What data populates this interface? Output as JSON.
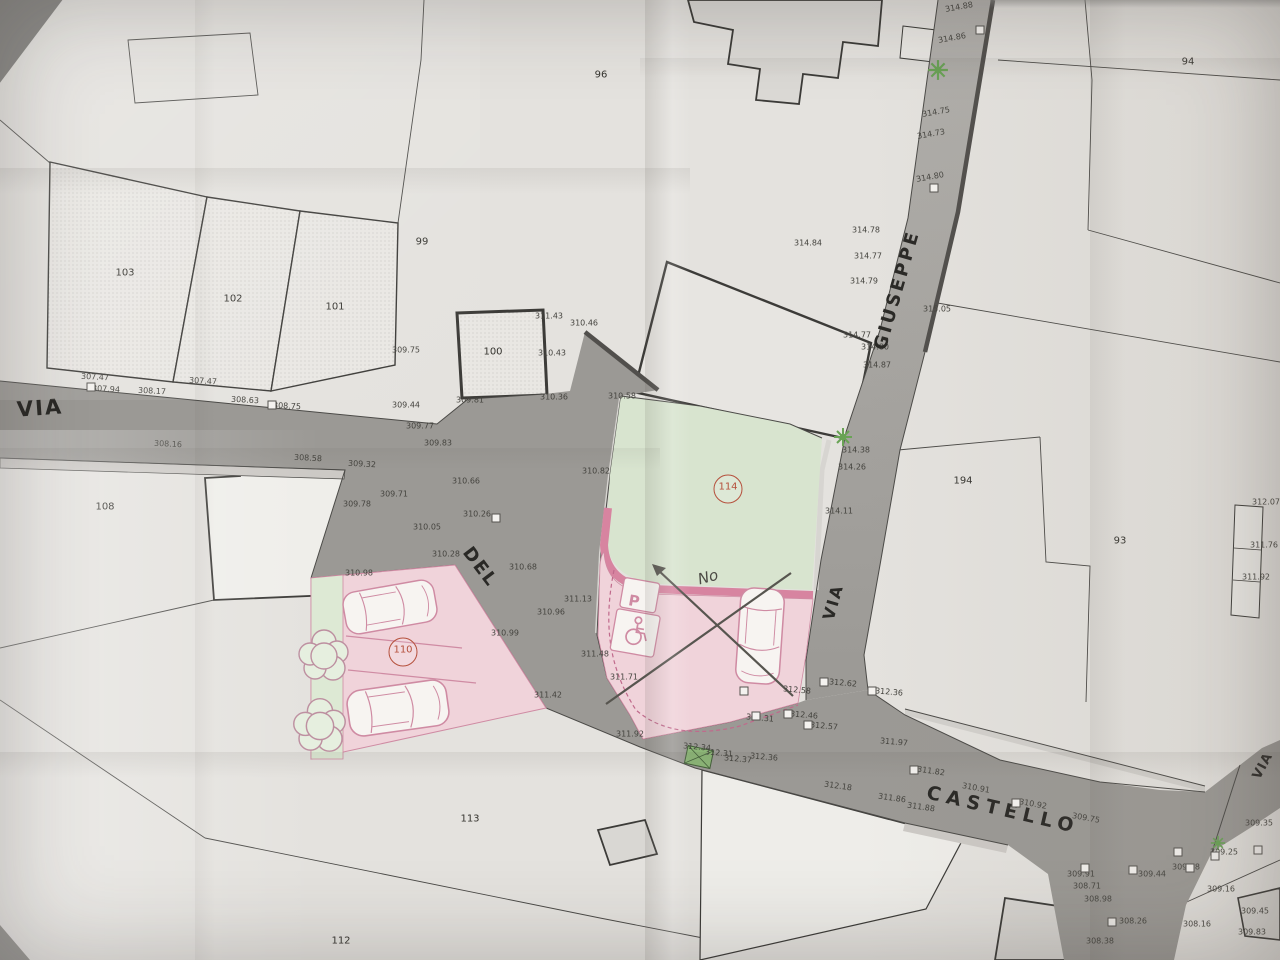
{
  "map": {
    "road_labels": [
      {
        "text": "VIA",
        "x": 40,
        "y": 408,
        "rot": -4,
        "size": 21,
        "ls": 2
      },
      {
        "text": "DEL",
        "x": 480,
        "y": 567,
        "rot": 53,
        "size": 18,
        "ls": 2
      },
      {
        "text": "CASTELLO",
        "x": 1003,
        "y": 810,
        "rot": 13,
        "size": 19,
        "ls": 6
      },
      {
        "text": "GIUSEPPE",
        "x": 897,
        "y": 290,
        "rot": -74,
        "size": 18,
        "ls": 3
      },
      {
        "text": "VIA",
        "x": 833,
        "y": 602,
        "rot": -74,
        "size": 16,
        "ls": 2
      },
      {
        "text": "VIA",
        "x": 1263,
        "y": 766,
        "rot": -62,
        "size": 13,
        "ls": 1
      }
    ],
    "parcel_labels": [
      {
        "text": "103",
        "x": 125,
        "y": 273
      },
      {
        "text": "102",
        "x": 233,
        "y": 299
      },
      {
        "text": "101",
        "x": 335,
        "y": 307
      },
      {
        "text": "99",
        "x": 422,
        "y": 242
      },
      {
        "text": "96",
        "x": 601,
        "y": 75
      },
      {
        "text": "100",
        "x": 493,
        "y": 352
      },
      {
        "text": "108",
        "x": 105,
        "y": 507
      },
      {
        "text": "113",
        "x": 470,
        "y": 819
      },
      {
        "text": "112",
        "x": 341,
        "y": 941
      },
      {
        "text": "194",
        "x": 963,
        "y": 481
      },
      {
        "text": "93",
        "x": 1120,
        "y": 541
      },
      {
        "text": "94",
        "x": 1188,
        "y": 62
      }
    ],
    "zone_badges": [
      {
        "text": "110",
        "x": 403,
        "y": 652
      },
      {
        "text": "114",
        "x": 728,
        "y": 489
      }
    ],
    "misc_labels": [
      {
        "text": "No",
        "x": 708,
        "y": 577,
        "rot": -15,
        "cls": "handnote"
      },
      {
        "text": "P",
        "x": 634,
        "y": 601,
        "rot": 10,
        "cls": "psign"
      }
    ],
    "spot_elevations": [
      {
        "t": "307.47",
        "x": 95,
        "y": 377,
        "r": 3
      },
      {
        "t": "307.47",
        "x": 203,
        "y": 381,
        "r": 3
      },
      {
        "t": "307.94",
        "x": 106,
        "y": 389,
        "r": 3
      },
      {
        "t": "308.17",
        "x": 152,
        "y": 391,
        "r": 3
      },
      {
        "t": "308.63",
        "x": 245,
        "y": 400,
        "r": 3
      },
      {
        "t": "308.75",
        "x": 287,
        "y": 406,
        "r": 3
      },
      {
        "t": "308.16",
        "x": 168,
        "y": 444,
        "r": 3
      },
      {
        "t": "308.58",
        "x": 308,
        "y": 458,
        "r": 3
      },
      {
        "t": "309.32",
        "x": 362,
        "y": 464,
        "r": 3
      },
      {
        "t": "309.44",
        "x": 406,
        "y": 405,
        "r": 0
      },
      {
        "t": "309.75",
        "x": 406,
        "y": 350,
        "r": 0
      },
      {
        "t": "309.77",
        "x": 420,
        "y": 426,
        "r": 0
      },
      {
        "t": "309.83",
        "x": 438,
        "y": 443,
        "r": 0
      },
      {
        "t": "309.71",
        "x": 394,
        "y": 494,
        "r": 0
      },
      {
        "t": "309.78",
        "x": 357,
        "y": 504,
        "r": 0
      },
      {
        "t": "310.05",
        "x": 427,
        "y": 527,
        "r": 0
      },
      {
        "t": "310.26",
        "x": 477,
        "y": 514,
        "r": 0
      },
      {
        "t": "310.28",
        "x": 446,
        "y": 554,
        "r": 0
      },
      {
        "t": "310.66",
        "x": 466,
        "y": 481,
        "r": 0
      },
      {
        "t": "310.68",
        "x": 523,
        "y": 567,
        "r": 0
      },
      {
        "t": "310.98",
        "x": 359,
        "y": 573,
        "r": 0
      },
      {
        "t": "310.96",
        "x": 551,
        "y": 612,
        "r": 0
      },
      {
        "t": "311.13",
        "x": 578,
        "y": 599,
        "r": 0
      },
      {
        "t": "310.99",
        "x": 505,
        "y": 633,
        "r": 0
      },
      {
        "t": "311.48",
        "x": 595,
        "y": 654,
        "r": 0
      },
      {
        "t": "311.71",
        "x": 624,
        "y": 677,
        "r": 0
      },
      {
        "t": "311.42",
        "x": 548,
        "y": 695,
        "r": 0
      },
      {
        "t": "311.92",
        "x": 630,
        "y": 734,
        "r": 0
      },
      {
        "t": "311.43",
        "x": 549,
        "y": 316,
        "r": 0
      },
      {
        "t": "310.46",
        "x": 584,
        "y": 323,
        "r": 0
      },
      {
        "t": "310.43",
        "x": 552,
        "y": 353,
        "r": 0
      },
      {
        "t": "309.81",
        "x": 470,
        "y": 400,
        "r": 0
      },
      {
        "t": "310.36",
        "x": 554,
        "y": 397,
        "r": 0
      },
      {
        "t": "310.58",
        "x": 622,
        "y": 396,
        "r": 0
      },
      {
        "t": "310.82",
        "x": 596,
        "y": 471,
        "r": 0
      },
      {
        "t": "314.84",
        "x": 808,
        "y": 243,
        "r": 0
      },
      {
        "t": "312.34",
        "x": 697,
        "y": 747,
        "r": 5
      },
      {
        "t": "312.31",
        "x": 719,
        "y": 753,
        "r": 5
      },
      {
        "t": "312.37",
        "x": 738,
        "y": 759,
        "r": 5
      },
      {
        "t": "312.36",
        "x": 764,
        "y": 757,
        "r": 5
      },
      {
        "t": "312.31",
        "x": 760,
        "y": 718,
        "r": 5
      },
      {
        "t": "312.58",
        "x": 797,
        "y": 690,
        "r": 5
      },
      {
        "t": "312.46",
        "x": 804,
        "y": 715,
        "r": 5
      },
      {
        "t": "312.57",
        "x": 824,
        "y": 726,
        "r": 5
      },
      {
        "t": "312.62",
        "x": 843,
        "y": 683,
        "r": 5
      },
      {
        "t": "312.36",
        "x": 889,
        "y": 692,
        "r": 5
      },
      {
        "t": "311.97",
        "x": 894,
        "y": 742,
        "r": 5
      },
      {
        "t": "312.18",
        "x": 838,
        "y": 786,
        "r": 8
      },
      {
        "t": "311.86",
        "x": 892,
        "y": 798,
        "r": 8
      },
      {
        "t": "311.88",
        "x": 921,
        "y": 807,
        "r": 8
      },
      {
        "t": "311.82",
        "x": 931,
        "y": 771,
        "r": 8
      },
      {
        "t": "310.91",
        "x": 976,
        "y": 788,
        "r": 10
      },
      {
        "t": "310.92",
        "x": 1033,
        "y": 804,
        "r": 10
      },
      {
        "t": "309.75",
        "x": 1086,
        "y": 818,
        "r": 10
      },
      {
        "t": "314.88",
        "x": 959,
        "y": 7,
        "r": -10
      },
      {
        "t": "314.86",
        "x": 952,
        "y": 38,
        "r": -10
      },
      {
        "t": "314.75",
        "x": 936,
        "y": 112,
        "r": -10
      },
      {
        "t": "314.73",
        "x": 931,
        "y": 134,
        "r": -10
      },
      {
        "t": "314.80",
        "x": 930,
        "y": 177,
        "r": -10
      },
      {
        "t": "314.78",
        "x": 866,
        "y": 230,
        "r": 0
      },
      {
        "t": "314.77",
        "x": 868,
        "y": 256,
        "r": 0
      },
      {
        "t": "314.79",
        "x": 864,
        "y": 281,
        "r": 0
      },
      {
        "t": "314.77",
        "x": 857,
        "y": 335,
        "r": 0
      },
      {
        "t": "314.80",
        "x": 875,
        "y": 347,
        "r": 0
      },
      {
        "t": "314.87",
        "x": 877,
        "y": 365,
        "r": 0
      },
      {
        "t": "315.05",
        "x": 937,
        "y": 309,
        "r": 0
      },
      {
        "t": "314.38",
        "x": 856,
        "y": 450,
        "r": 0
      },
      {
        "t": "314.26",
        "x": 852,
        "y": 467,
        "r": 0
      },
      {
        "t": "314.11",
        "x": 839,
        "y": 511,
        "r": 0
      },
      {
        "t": "312.07",
        "x": 1266,
        "y": 502,
        "r": 0
      },
      {
        "t": "311.76",
        "x": 1264,
        "y": 545,
        "r": 0
      },
      {
        "t": "311.92",
        "x": 1256,
        "y": 577,
        "r": 0
      },
      {
        "t": "309.91",
        "x": 1081,
        "y": 874,
        "r": 0
      },
      {
        "t": "308.71",
        "x": 1087,
        "y": 886,
        "r": 0
      },
      {
        "t": "308.98",
        "x": 1098,
        "y": 899,
        "r": 0
      },
      {
        "t": "309.25",
        "x": 1224,
        "y": 852,
        "r": 0
      },
      {
        "t": "309.28",
        "x": 1186,
        "y": 867,
        "r": 0
      },
      {
        "t": "309.44",
        "x": 1152,
        "y": 874,
        "r": 0
      },
      {
        "t": "309.16",
        "x": 1221,
        "y": 889,
        "r": 0
      },
      {
        "t": "308.26",
        "x": 1133,
        "y": 921,
        "r": 0
      },
      {
        "t": "308.16",
        "x": 1197,
        "y": 924,
        "r": 0
      },
      {
        "t": "308.38",
        "x": 1100,
        "y": 941,
        "r": 0
      },
      {
        "t": "309.35",
        "x": 1259,
        "y": 823,
        "r": 0
      },
      {
        "t": "309.45",
        "x": 1255,
        "y": 911,
        "r": 0
      },
      {
        "t": "309.83",
        "x": 1252,
        "y": 932,
        "r": 0
      }
    ],
    "benchmarks": [
      [
        91,
        387
      ],
      [
        272,
        405
      ],
      [
        496,
        518
      ],
      [
        756,
        716
      ],
      [
        788,
        714
      ],
      [
        808,
        725
      ],
      [
        824,
        682
      ],
      [
        872,
        691
      ],
      [
        914,
        770
      ],
      [
        1016,
        803
      ],
      [
        980,
        30
      ],
      [
        934,
        188
      ],
      [
        1133,
        870
      ],
      [
        1178,
        852
      ],
      [
        1215,
        856
      ],
      [
        1258,
        850
      ],
      [
        1190,
        868
      ],
      [
        1112,
        922
      ],
      [
        1085,
        868
      ],
      [
        744,
        691
      ]
    ],
    "colors": {
      "paper": "#e4e2de",
      "road": "#9b9995",
      "road_vertical": "#a9a7a3",
      "sidewalk": "#ccc9c5",
      "green_area": "#d8e4cf",
      "green_strip": "#dde9d4",
      "pink_area": "#f0d3da",
      "pink_band": "#d784a0",
      "car_outline": "#cf8ba3",
      "badge_red": "#b5503c",
      "tree_green": "#69a355",
      "pencil": "#57554f",
      "line": "#4b4a47"
    }
  }
}
